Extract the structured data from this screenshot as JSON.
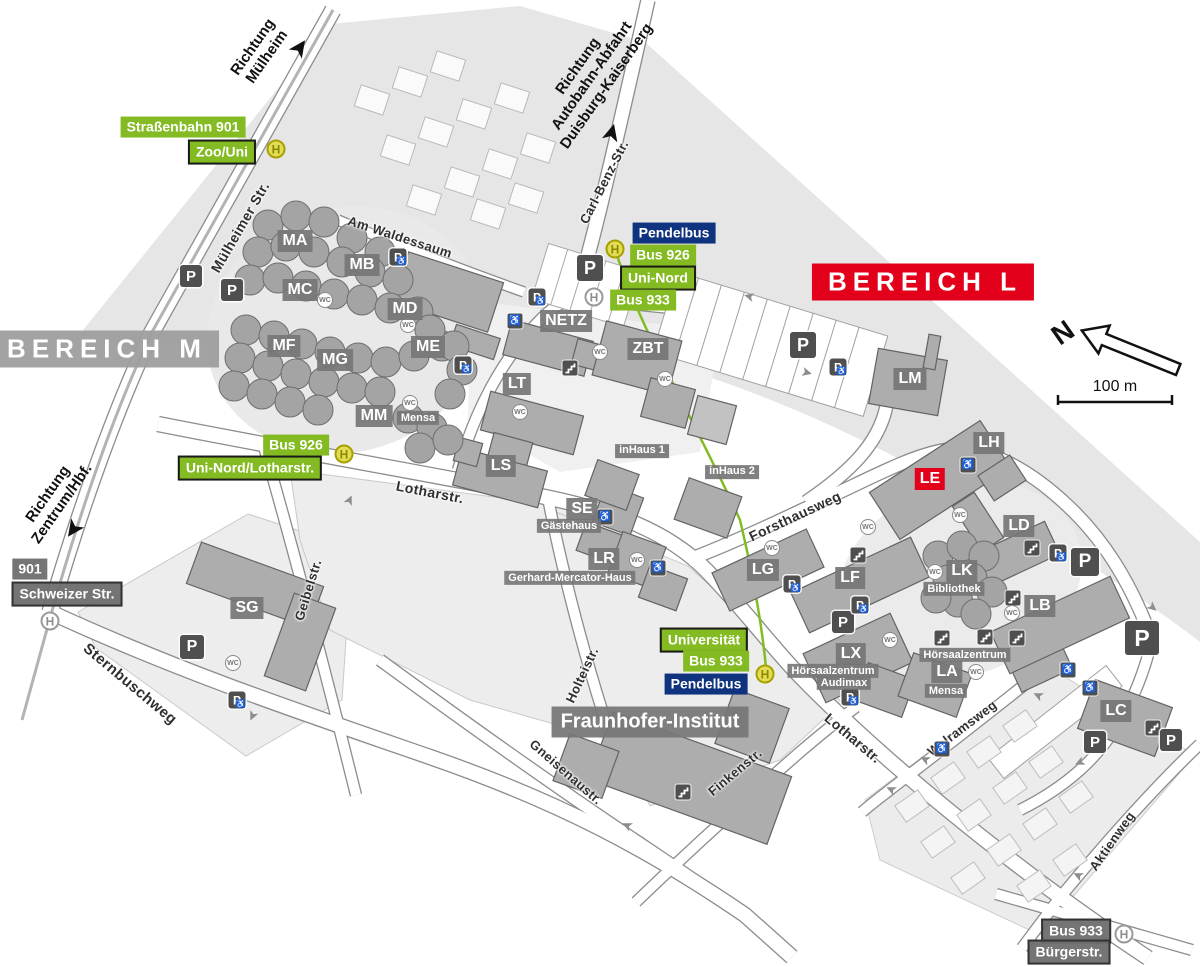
{
  "stop_letter": "H",
  "icons": {
    "parking_letter": "P",
    "wc_label": "WC",
    "wheelchair_glyph": "♿",
    "arrow_glyph": "➤"
  },
  "colors": {
    "green": "#84bb22",
    "navy": "#10337f",
    "red": "#e2001a",
    "badge_gray": "#767676",
    "stop_yellow": "#e3dc55"
  },
  "compass": {
    "letter": "N",
    "scale_label": "100 m"
  },
  "areas": [
    {
      "text": "BEREICH M",
      "x": 105,
      "y": 349,
      "style": "gray"
    },
    {
      "text": "BEREICH L",
      "x": 923,
      "y": 282,
      "style": "red"
    }
  ],
  "buildings": [
    {
      "text": "MA",
      "x": 295,
      "y": 241
    },
    {
      "text": "MB",
      "x": 362,
      "y": 265
    },
    {
      "text": "MC",
      "x": 300,
      "y": 290
    },
    {
      "text": "MD",
      "x": 405,
      "y": 309
    },
    {
      "text": "ME",
      "x": 428,
      "y": 347
    },
    {
      "text": "MF",
      "x": 284,
      "y": 346
    },
    {
      "text": "MG",
      "x": 335,
      "y": 360
    },
    {
      "text": "MM",
      "x": 374,
      "y": 416
    },
    {
      "text": "NETZ",
      "x": 566,
      "y": 321
    },
    {
      "text": "ZBT",
      "x": 648,
      "y": 349
    },
    {
      "text": "LT",
      "x": 517,
      "y": 384
    },
    {
      "text": "LS",
      "x": 501,
      "y": 466
    },
    {
      "text": "SE",
      "x": 582,
      "y": 509
    },
    {
      "text": "LR",
      "x": 604,
      "y": 559
    },
    {
      "text": "inHaus 1",
      "x": 642,
      "y": 451,
      "variant": "small"
    },
    {
      "text": "inHaus 2",
      "x": 732,
      "y": 472,
      "variant": "small"
    },
    {
      "text": "SG",
      "x": 247,
      "y": 608
    },
    {
      "text": "LG",
      "x": 763,
      "y": 570
    },
    {
      "text": "LF",
      "x": 850,
      "y": 578
    },
    {
      "text": "LX",
      "x": 851,
      "y": 654
    },
    {
      "text": "LK",
      "x": 962,
      "y": 571
    },
    {
      "text": "LA",
      "x": 947,
      "y": 672
    },
    {
      "text": "LB",
      "x": 1040,
      "y": 606
    },
    {
      "text": "LC",
      "x": 1116,
      "y": 711
    },
    {
      "text": "LD",
      "x": 1019,
      "y": 526
    },
    {
      "text": "LE",
      "x": 930,
      "y": 479,
      "variant": "red"
    },
    {
      "text": "LH",
      "x": 989,
      "y": 443
    },
    {
      "text": "LM",
      "x": 910,
      "y": 379
    },
    {
      "text": "Fraunhofer-Institut",
      "x": 650,
      "y": 722,
      "variant": "wide"
    }
  ],
  "sublabels": [
    {
      "text": "Mensa",
      "x": 418,
      "y": 418
    },
    {
      "text": "Gästehaus",
      "x": 569,
      "y": 526
    },
    {
      "text": "Gerhard-Mercator-Haus",
      "x": 570,
      "y": 578
    },
    {
      "text": "Bibliothek",
      "x": 954,
      "y": 589
    },
    {
      "text": "Hörsaalzentrum",
      "x": 833,
      "y": 671
    },
    {
      "text": "Audimax",
      "x": 844,
      "y": 683
    },
    {
      "text": "Hörsaalzentrum",
      "x": 965,
      "y": 655
    },
    {
      "text": "Mensa",
      "x": 946,
      "y": 691
    }
  ],
  "transit": [
    {
      "text": "Straßenbahn 901",
      "x": 183,
      "y": 127,
      "style": "green"
    },
    {
      "text": "Zoo/Uni",
      "x": 222,
      "y": 152,
      "style": "green-border"
    },
    {
      "text": "Pendelbus",
      "x": 674,
      "y": 233,
      "style": "navy"
    },
    {
      "text": "Bus 926",
      "x": 663,
      "y": 255,
      "style": "green"
    },
    {
      "text": "Uni-Nord",
      "x": 658,
      "y": 278,
      "style": "green-border"
    },
    {
      "text": "Bus 933",
      "x": 643,
      "y": 300,
      "style": "green"
    },
    {
      "text": "Bus 926",
      "x": 296,
      "y": 445,
      "style": "green"
    },
    {
      "text": "Uni-Nord/Lotharstr.",
      "x": 250,
      "y": 468,
      "style": "green-border"
    },
    {
      "text": "Universität",
      "x": 704,
      "y": 640,
      "style": "green-border"
    },
    {
      "text": "Bus 933",
      "x": 716,
      "y": 661,
      "style": "green"
    },
    {
      "text": "Pendelbus",
      "x": 706,
      "y": 684,
      "style": "navy"
    },
    {
      "text": "901",
      "x": 30,
      "y": 569,
      "style": "gray"
    },
    {
      "text": "Schweizer Str.",
      "x": 67,
      "y": 594,
      "style": "gray-border"
    },
    {
      "text": "Bus 933",
      "x": 1076,
      "y": 931,
      "style": "gray-border"
    },
    {
      "text": "Bürgerstr.",
      "x": 1069,
      "y": 952,
      "style": "gray-border"
    }
  ],
  "stops": [
    {
      "x": 276,
      "y": 149,
      "variant": "active"
    },
    {
      "x": 615,
      "y": 249,
      "variant": "active"
    },
    {
      "x": 594,
      "y": 297,
      "variant": "inactive"
    },
    {
      "x": 344,
      "y": 454,
      "variant": "active"
    },
    {
      "x": 765,
      "y": 674,
      "variant": "active"
    },
    {
      "x": 50,
      "y": 621,
      "variant": "inactive"
    },
    {
      "x": 1124,
      "y": 934,
      "variant": "inactive"
    }
  ],
  "streets": [
    {
      "text": "Mülheimer Str.",
      "x": 240,
      "y": 227,
      "rot": -60,
      "size": 14
    },
    {
      "text": "Am Waldessaum",
      "x": 400,
      "y": 237,
      "rot": 18,
      "size": 13
    },
    {
      "text": "Carl-Benz-Str.",
      "x": 604,
      "y": 182,
      "rot": -63,
      "size": 13
    },
    {
      "text": "Lotharstr.",
      "x": 430,
      "y": 492,
      "rot": 11,
      "size": 14
    },
    {
      "text": "Forsthausweg",
      "x": 795,
      "y": 516,
      "rot": -25,
      "size": 14
    },
    {
      "text": "Geibelstr.",
      "x": 308,
      "y": 590,
      "rot": -73,
      "size": 13
    },
    {
      "text": "Sternbuschweg",
      "x": 130,
      "y": 684,
      "rot": 40,
      "size": 15
    },
    {
      "text": "Holteistr.",
      "x": 582,
      "y": 675,
      "rot": -65,
      "size": 13
    },
    {
      "text": "Gneisenaustr.",
      "x": 566,
      "y": 772,
      "rot": 41,
      "size": 13
    },
    {
      "text": "Finkenstr.",
      "x": 735,
      "y": 772,
      "rot": -40,
      "size": 13
    },
    {
      "text": "Lotharstr.",
      "x": 853,
      "y": 738,
      "rot": 40,
      "size": 14
    },
    {
      "text": "Walramsweg",
      "x": 962,
      "y": 728,
      "rot": -37,
      "size": 13
    },
    {
      "text": "Aktienweg",
      "x": 1112,
      "y": 841,
      "rot": -55,
      "size": 13
    }
  ],
  "directions": [
    {
      "lines": [
        "Richtung",
        "Mülheim"
      ],
      "x": 260,
      "y": 52,
      "rot": -55,
      "arrow": {
        "x": 300,
        "y": 48,
        "rot": -55
      }
    },
    {
      "lines": [
        "Richtung",
        "Autobahn-Abfahrt",
        "Duisburg-Kaiserberg"
      ],
      "x": 592,
      "y": 76,
      "rot": -55,
      "arrow": {
        "x": 612,
        "y": 133,
        "rot": -75
      }
    },
    {
      "lines": [
        "Richtung",
        "Zentrum/Hbf."
      ],
      "x": 55,
      "y": 499,
      "rot": -55,
      "arrow": {
        "x": 73,
        "y": 529,
        "rot": 125
      }
    }
  ],
  "parking": [
    {
      "x": 191,
      "y": 276,
      "s": 22
    },
    {
      "x": 232,
      "y": 290,
      "s": 22
    },
    {
      "x": 398,
      "y": 257,
      "s": 17,
      "wc": true
    },
    {
      "x": 463,
      "y": 365,
      "s": 17,
      "wc": true
    },
    {
      "x": 537,
      "y": 297,
      "s": 17,
      "wc": true
    },
    {
      "x": 590,
      "y": 268,
      "s": 26
    },
    {
      "x": 803,
      "y": 345,
      "s": 26
    },
    {
      "x": 838,
      "y": 367,
      "s": 17,
      "wc": true
    },
    {
      "x": 192,
      "y": 647,
      "s": 24
    },
    {
      "x": 237,
      "y": 700,
      "s": 17,
      "wc": true
    },
    {
      "x": 792,
      "y": 584,
      "s": 17,
      "wc": true
    },
    {
      "x": 843,
      "y": 622,
      "s": 22
    },
    {
      "x": 860,
      "y": 605,
      "s": 17,
      "wc": true
    },
    {
      "x": 850,
      "y": 697,
      "s": 17,
      "wc": true
    },
    {
      "x": 1058,
      "y": 553,
      "s": 17,
      "wc": true
    },
    {
      "x": 1085,
      "y": 562,
      "s": 28
    },
    {
      "x": 1142,
      "y": 638,
      "s": 34
    },
    {
      "x": 1095,
      "y": 742,
      "s": 22
    },
    {
      "x": 1171,
      "y": 740,
      "s": 22
    }
  ],
  "wheelchairs": [
    {
      "x": 515,
      "y": 321
    },
    {
      "x": 605,
      "y": 517
    },
    {
      "x": 658,
      "y": 568
    },
    {
      "x": 968,
      "y": 465
    },
    {
      "x": 1068,
      "y": 670
    },
    {
      "x": 1090,
      "y": 688
    },
    {
      "x": 942,
      "y": 749
    }
  ],
  "wcs": [
    {
      "x": 325,
      "y": 300
    },
    {
      "x": 408,
      "y": 325
    },
    {
      "x": 410,
      "y": 403
    },
    {
      "x": 520,
      "y": 412
    },
    {
      "x": 600,
      "y": 352
    },
    {
      "x": 665,
      "y": 379
    },
    {
      "x": 960,
      "y": 515
    },
    {
      "x": 935,
      "y": 572
    },
    {
      "x": 772,
      "y": 548
    },
    {
      "x": 868,
      "y": 527
    },
    {
      "x": 1012,
      "y": 613
    },
    {
      "x": 976,
      "y": 672
    },
    {
      "x": 233,
      "y": 663
    },
    {
      "x": 890,
      "y": 640
    },
    {
      "x": 637,
      "y": 560
    }
  ],
  "stairs": [
    {
      "x": 570,
      "y": 368
    },
    {
      "x": 1032,
      "y": 548
    },
    {
      "x": 1013,
      "y": 598
    },
    {
      "x": 858,
      "y": 555
    },
    {
      "x": 942,
      "y": 638
    },
    {
      "x": 985,
      "y": 637
    },
    {
      "x": 1017,
      "y": 638
    },
    {
      "x": 683,
      "y": 792
    },
    {
      "x": 1153,
      "y": 728
    }
  ],
  "road_arrows": [
    {
      "x": 749,
      "y": 297,
      "rot": 195
    },
    {
      "x": 807,
      "y": 372,
      "rot": 15
    },
    {
      "x": 349,
      "y": 500,
      "rot": -65
    },
    {
      "x": 253,
      "y": 716,
      "rot": 115
    },
    {
      "x": 925,
      "y": 760,
      "rot": 205
    },
    {
      "x": 1038,
      "y": 696,
      "rot": 205
    },
    {
      "x": 1153,
      "y": 607,
      "rot": 40
    },
    {
      "x": 1080,
      "y": 763,
      "rot": 155
    },
    {
      "x": 1078,
      "y": 876,
      "rot": 205
    },
    {
      "x": 627,
      "y": 826,
      "rot": 205
    },
    {
      "x": 891,
      "y": 790,
      "rot": 205
    }
  ]
}
